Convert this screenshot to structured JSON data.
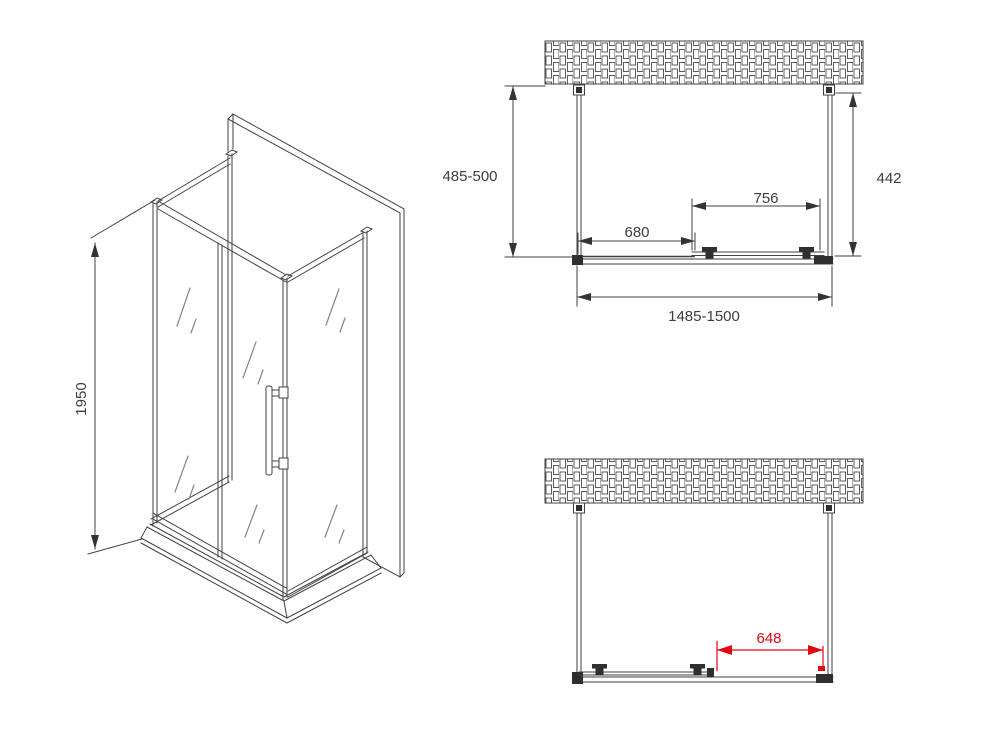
{
  "colors": {
    "line": "#414141",
    "accent_red": "#e30613",
    "background": "#ffffff"
  },
  "isometric_view": {
    "height_label": "1950"
  },
  "plan_view_closed": {
    "side_depth_label": "485-500",
    "wall_offset_label": "442",
    "door_width_label": "756",
    "fixed_panel_label": "680",
    "overall_width_label": "1485-1500"
  },
  "plan_view_open": {
    "opening_label": "648"
  }
}
